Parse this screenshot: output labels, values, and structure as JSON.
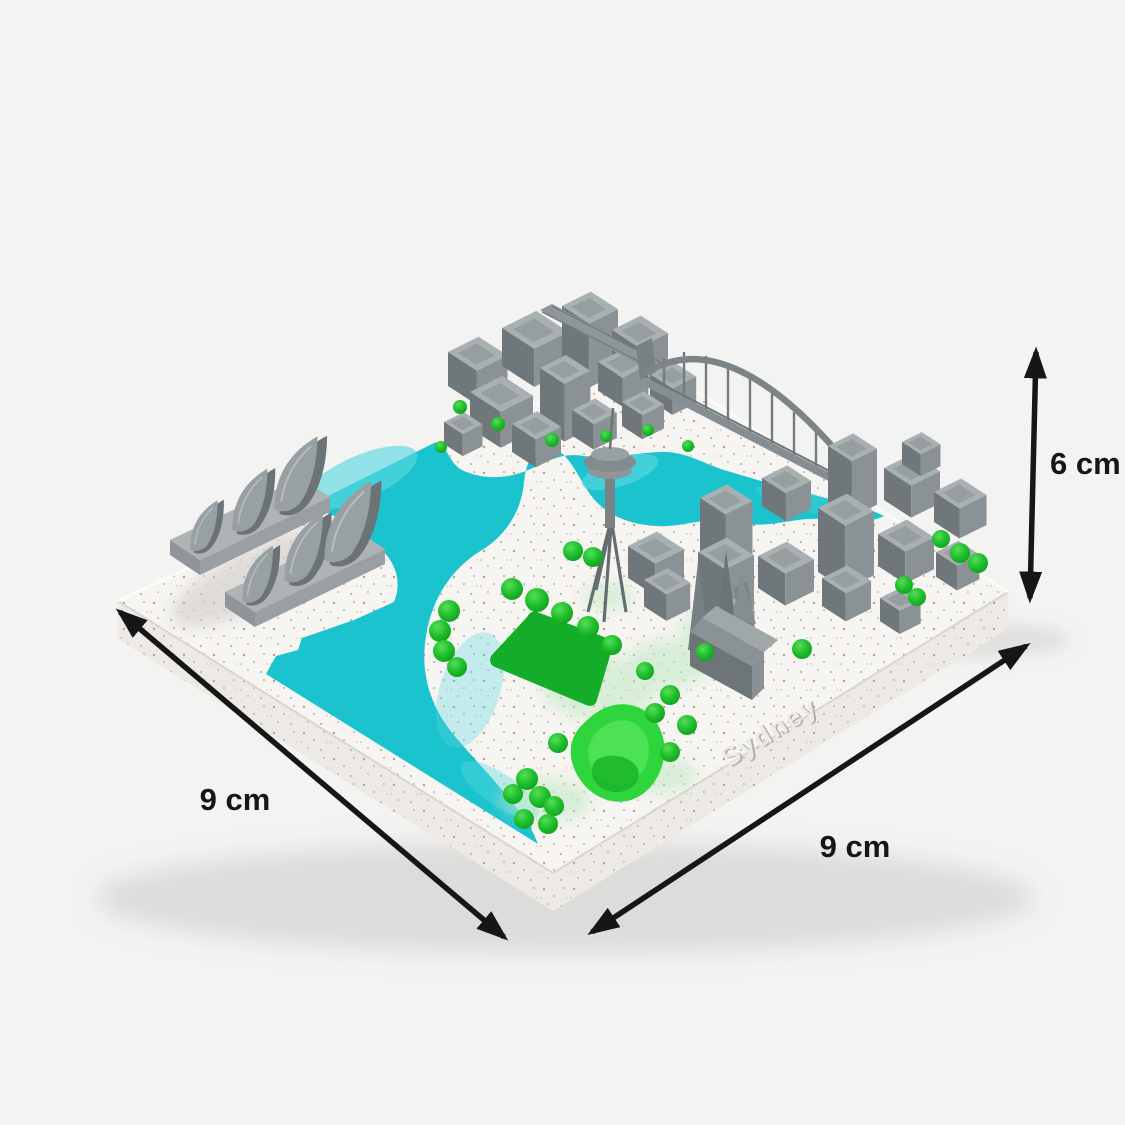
{
  "photo": {
    "subject": "3D printed miniature city map model of Sydney",
    "embossed_text": "Sydney"
  },
  "annotations": {
    "width_label": "9 cm",
    "depth_label": "9 cm",
    "height_label": "6 cm"
  },
  "colors": {
    "background": "#f3f3f2",
    "base_top": "#f7f5f2",
    "base_side": "#edeae6",
    "water": "#1bc3cf",
    "water_light": "#5ad8df",
    "building_gray": "#8b9295",
    "building_dark": "#70777a",
    "building_light": "#a9b0b2",
    "tree_green": "#22c32d",
    "park_green": "#13ad29",
    "park_bright_green": "#2fd53c",
    "arrow_black": "#161616"
  }
}
